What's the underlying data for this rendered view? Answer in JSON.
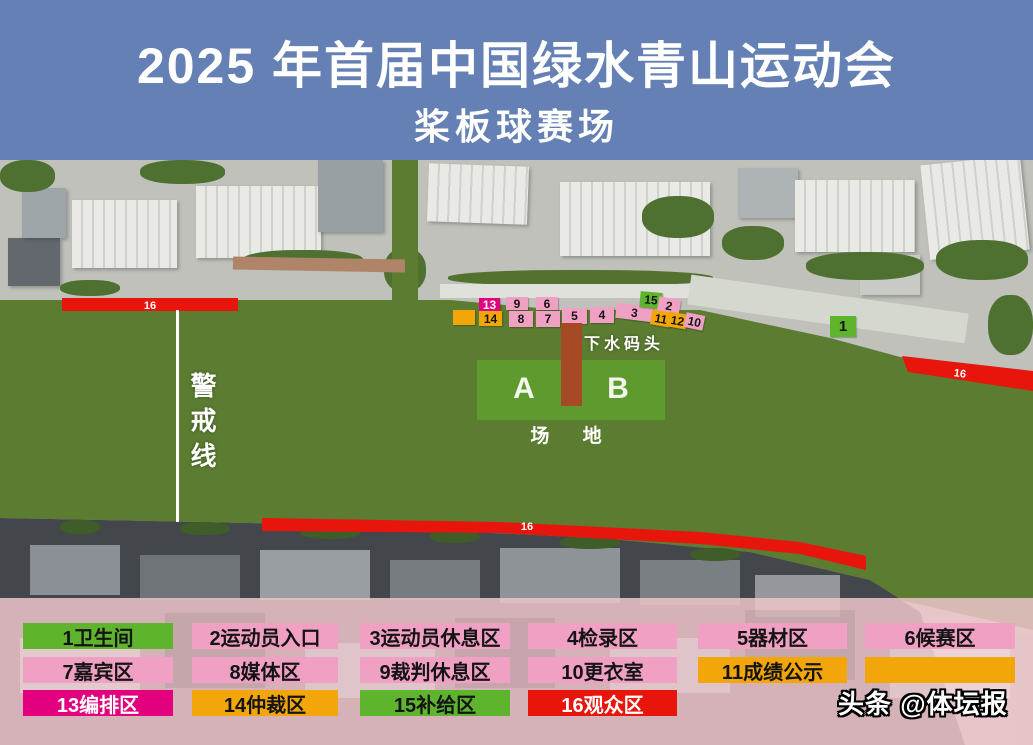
{
  "title": {
    "line1": "2025 年首届中国绿水青山运动会",
    "line2": "桨板球赛场"
  },
  "palette": {
    "pink": "#F0A0C3",
    "green": "#5FB42E",
    "orange": "#F2A609",
    "magenta": "#E2007E",
    "red": "#E8150D",
    "dock_red": "#A64A25",
    "water_green": "#5B7C31",
    "field_green": "#5F9A2F",
    "title_blue": "#6480B4"
  },
  "map": {
    "cordon_label": "警戒线",
    "dock_label": "下水码头",
    "field": {
      "a": "A",
      "b": "B",
      "caption": "场 地"
    },
    "bars": [
      {
        "id": "top-left",
        "label": "16"
      },
      {
        "id": "bottom",
        "label": "16"
      },
      {
        "id": "right",
        "label": "16"
      }
    ],
    "markers": [
      {
        "label": "",
        "color": "orange",
        "x": 453,
        "y": 150,
        "w": 22,
        "h": 15,
        "rot": 0
      },
      {
        "label": "13",
        "color": "magenta",
        "tc": "#fff",
        "x": 479,
        "y": 138,
        "w": 21,
        "h": 13,
        "rot": 0
      },
      {
        "label": "14",
        "color": "orange",
        "x": 479,
        "y": 151,
        "w": 23,
        "h": 15,
        "rot": 0
      },
      {
        "label": "9",
        "color": "pink",
        "x": 506,
        "y": 137,
        "w": 22,
        "h": 13,
        "rot": 0
      },
      {
        "label": "8",
        "color": "pink",
        "x": 509,
        "y": 151,
        "w": 24,
        "h": 16,
        "rot": 0
      },
      {
        "label": "6",
        "color": "pink",
        "x": 536,
        "y": 137,
        "w": 22,
        "h": 13,
        "rot": 0
      },
      {
        "label": "7",
        "color": "pink",
        "x": 536,
        "y": 151,
        "w": 24,
        "h": 16,
        "rot": 0
      },
      {
        "label": "5",
        "color": "pink",
        "x": 562,
        "y": 148,
        "w": 25,
        "h": 16,
        "rot": 0
      },
      {
        "label": "4",
        "color": "pink",
        "x": 590,
        "y": 147,
        "w": 24,
        "h": 16,
        "rot": 0
      },
      {
        "label": "3",
        "color": "pink",
        "x": 616,
        "y": 145,
        "w": 37,
        "h": 15,
        "rot": 7
      },
      {
        "label": "15",
        "color": "green",
        "x": 640,
        "y": 132,
        "w": 22,
        "h": 16,
        "rot": 5
      },
      {
        "label": "2",
        "color": "pink",
        "x": 658,
        "y": 138,
        "w": 22,
        "h": 16,
        "rot": 10
      },
      {
        "label": "11",
        "color": "orange",
        "x": 651,
        "y": 151,
        "w": 20,
        "h": 15,
        "rot": 10
      },
      {
        "label": "12",
        "color": "orange",
        "x": 668,
        "y": 153,
        "w": 19,
        "h": 15,
        "rot": 10
      },
      {
        "label": "10",
        "color": "pink",
        "x": 685,
        "y": 154,
        "w": 19,
        "h": 15,
        "rot": 12
      },
      {
        "label": "1",
        "color": "green",
        "x": 830,
        "y": 156,
        "w": 26,
        "h": 21,
        "rot": 0,
        "fs": 15
      }
    ]
  },
  "legend": {
    "items": [
      {
        "label": "1卫生间",
        "color": "green"
      },
      {
        "label": "2运动员入口",
        "color": "pink"
      },
      {
        "label": "3运动员休息区",
        "color": "pink"
      },
      {
        "label": "4检录区",
        "color": "pink"
      },
      {
        "label": "5器材区",
        "color": "pink"
      },
      {
        "label": "6候赛区",
        "color": "pink"
      },
      {
        "label": "7嘉宾区",
        "color": "pink"
      },
      {
        "label": "8媒体区",
        "color": "pink"
      },
      {
        "label": "9裁判休息区",
        "color": "pink"
      },
      {
        "label": "10更衣室",
        "color": "pink"
      },
      {
        "label": "11成绩公示",
        "color": "orange"
      },
      {
        "label": "",
        "color": "orange"
      },
      {
        "label": "13编排区",
        "color": "magenta",
        "tc": "#fff"
      },
      {
        "label": "14仲裁区",
        "color": "orange"
      },
      {
        "label": "15补给区",
        "color": "green"
      },
      {
        "label": "16观众区",
        "color": "red",
        "tc": "#fff"
      }
    ]
  },
  "watermark": "头条 @体坛报"
}
